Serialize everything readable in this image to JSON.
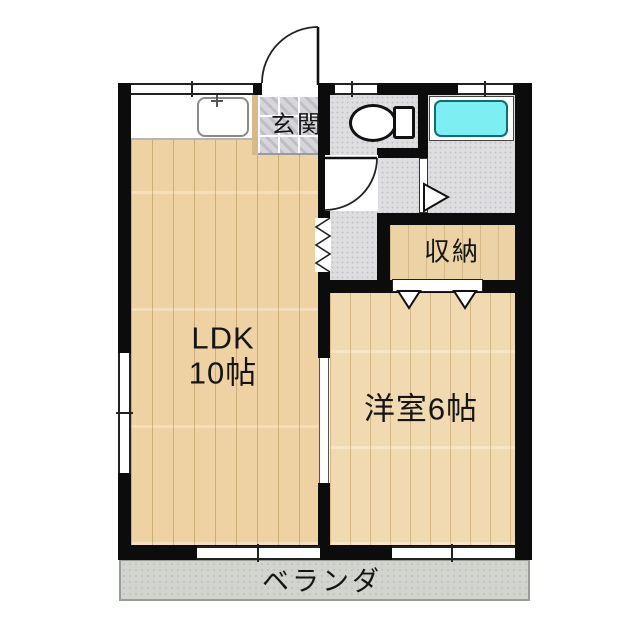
{
  "rooms": {
    "ldk": {
      "line1": "LDK",
      "line2": "10帖"
    },
    "western": {
      "label": "洋室6帖"
    },
    "genkan": {
      "label": "玄関"
    },
    "closet": {
      "label": "収納"
    },
    "veranda": {
      "label": "ベランダ"
    }
  },
  "fixtures": [
    "kitchen-sink-icon",
    "toilet-icon",
    "bathtub-icon",
    "entrance-door-swing-icon",
    "toilet-door-swing-icon",
    "folding-door-icon",
    "bifold-closet-door-icon",
    "bath-door-triangle-icon",
    "window-icon"
  ],
  "colors": {
    "wall": "#0c0c0c",
    "ldk_floor": "#eed2a4",
    "western_floor": "#f1dab1",
    "closet_floor": "#ecd3a6",
    "genkan_tile": "#d5d5da",
    "wet_area_floor": "#dedee1",
    "veranda": "#d2d5cf",
    "bathtub": "#7deef2",
    "background": "#ffffff"
  }
}
